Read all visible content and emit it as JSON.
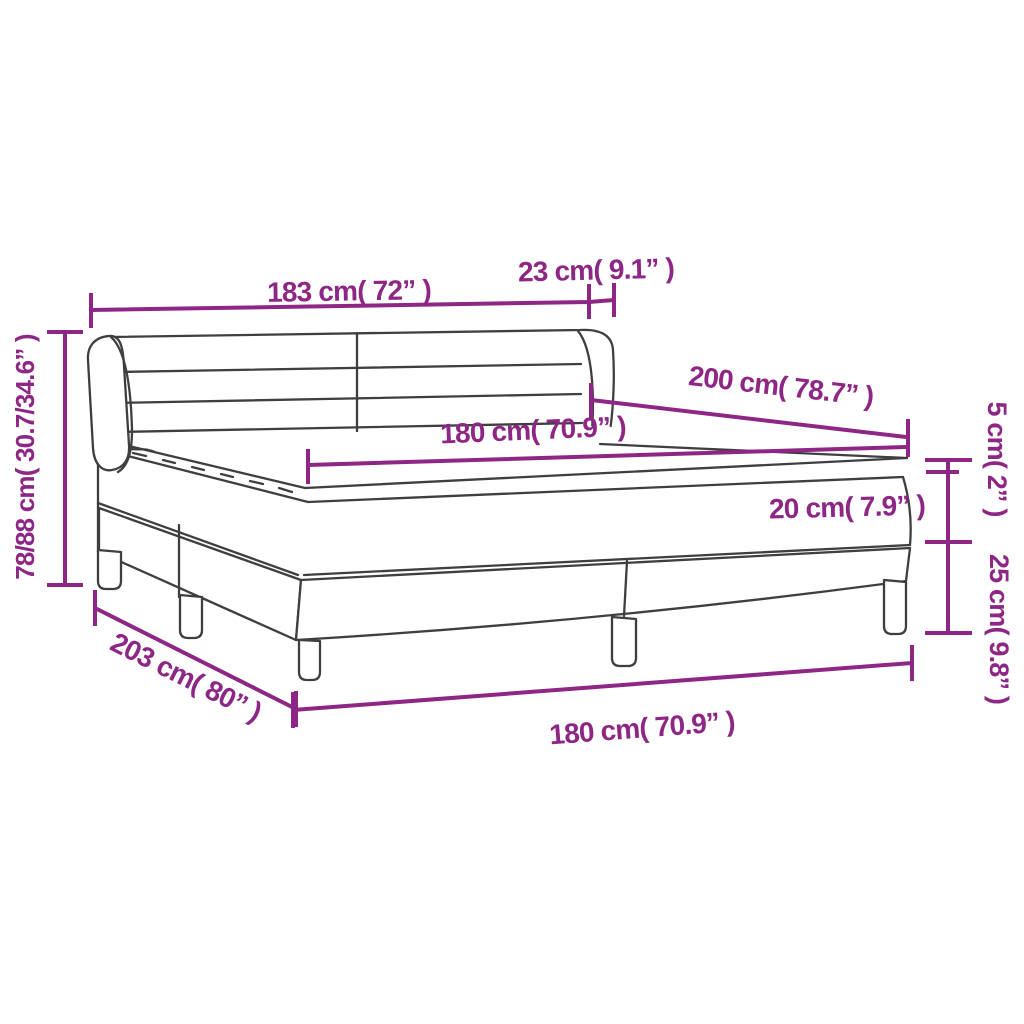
{
  "diagram": {
    "title": "box-spring-bed-dimension-diagram",
    "colors": {
      "background": "#ffffff",
      "line_art": "#3f3f3f",
      "dimension": "#8d2685"
    },
    "dimensions": {
      "headboard_width": {
        "label": "183 cm( 72” )"
      },
      "headboard_depth": {
        "label": "23 cm( 9.1” )"
      },
      "total_height": {
        "label": "78/88 cm( 30.7/34.6” )"
      },
      "bed_length": {
        "label": "200 cm( 78.7” )"
      },
      "mattress_width": {
        "label": "180 cm( 70.9” )"
      },
      "topper_height": {
        "label": "5 cm( 2” )"
      },
      "mattress_height": {
        "label": "20 cm( 7.9” )"
      },
      "base_height": {
        "label": "25 cm( 9.8” )"
      },
      "total_length": {
        "label": "203 cm( 80” )"
      },
      "base_width": {
        "label": "180 cm( 70.9” )"
      }
    }
  }
}
